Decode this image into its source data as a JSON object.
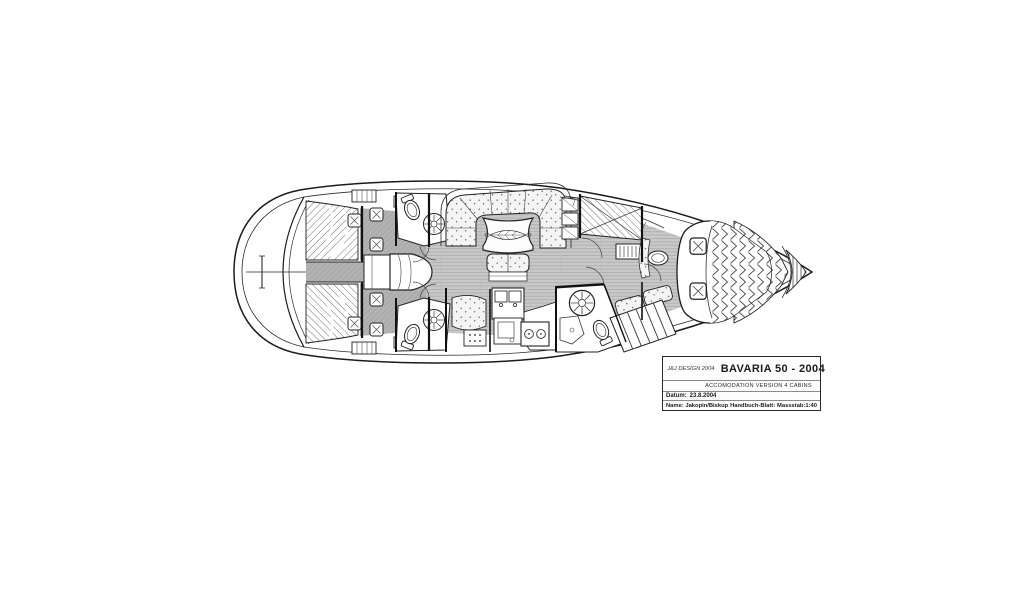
{
  "drawing": {
    "subject": "Sailing yacht interior accommodation plan, bow to the right",
    "colors": {
      "line": "#1b1b1b",
      "floor_light": "#c8c8c8",
      "floor_dark": "#b0b0b0",
      "upholstery": "#f4f4f4",
      "paper": "#ffffff"
    }
  },
  "title_block": {
    "designer": "J&J DESIGN 2004",
    "model": "BAVARIA 50 - 2004",
    "subtitle": "ACCOMODATION VERSION 4 CABINS",
    "date_label": "Datum:",
    "date_value": "23.8.2004",
    "name_label": "Name:",
    "name_value": "Jakopin/Biskup",
    "sheet_label": "Handbuch-Blatt:",
    "scale_label": "Massstab:1:40"
  }
}
